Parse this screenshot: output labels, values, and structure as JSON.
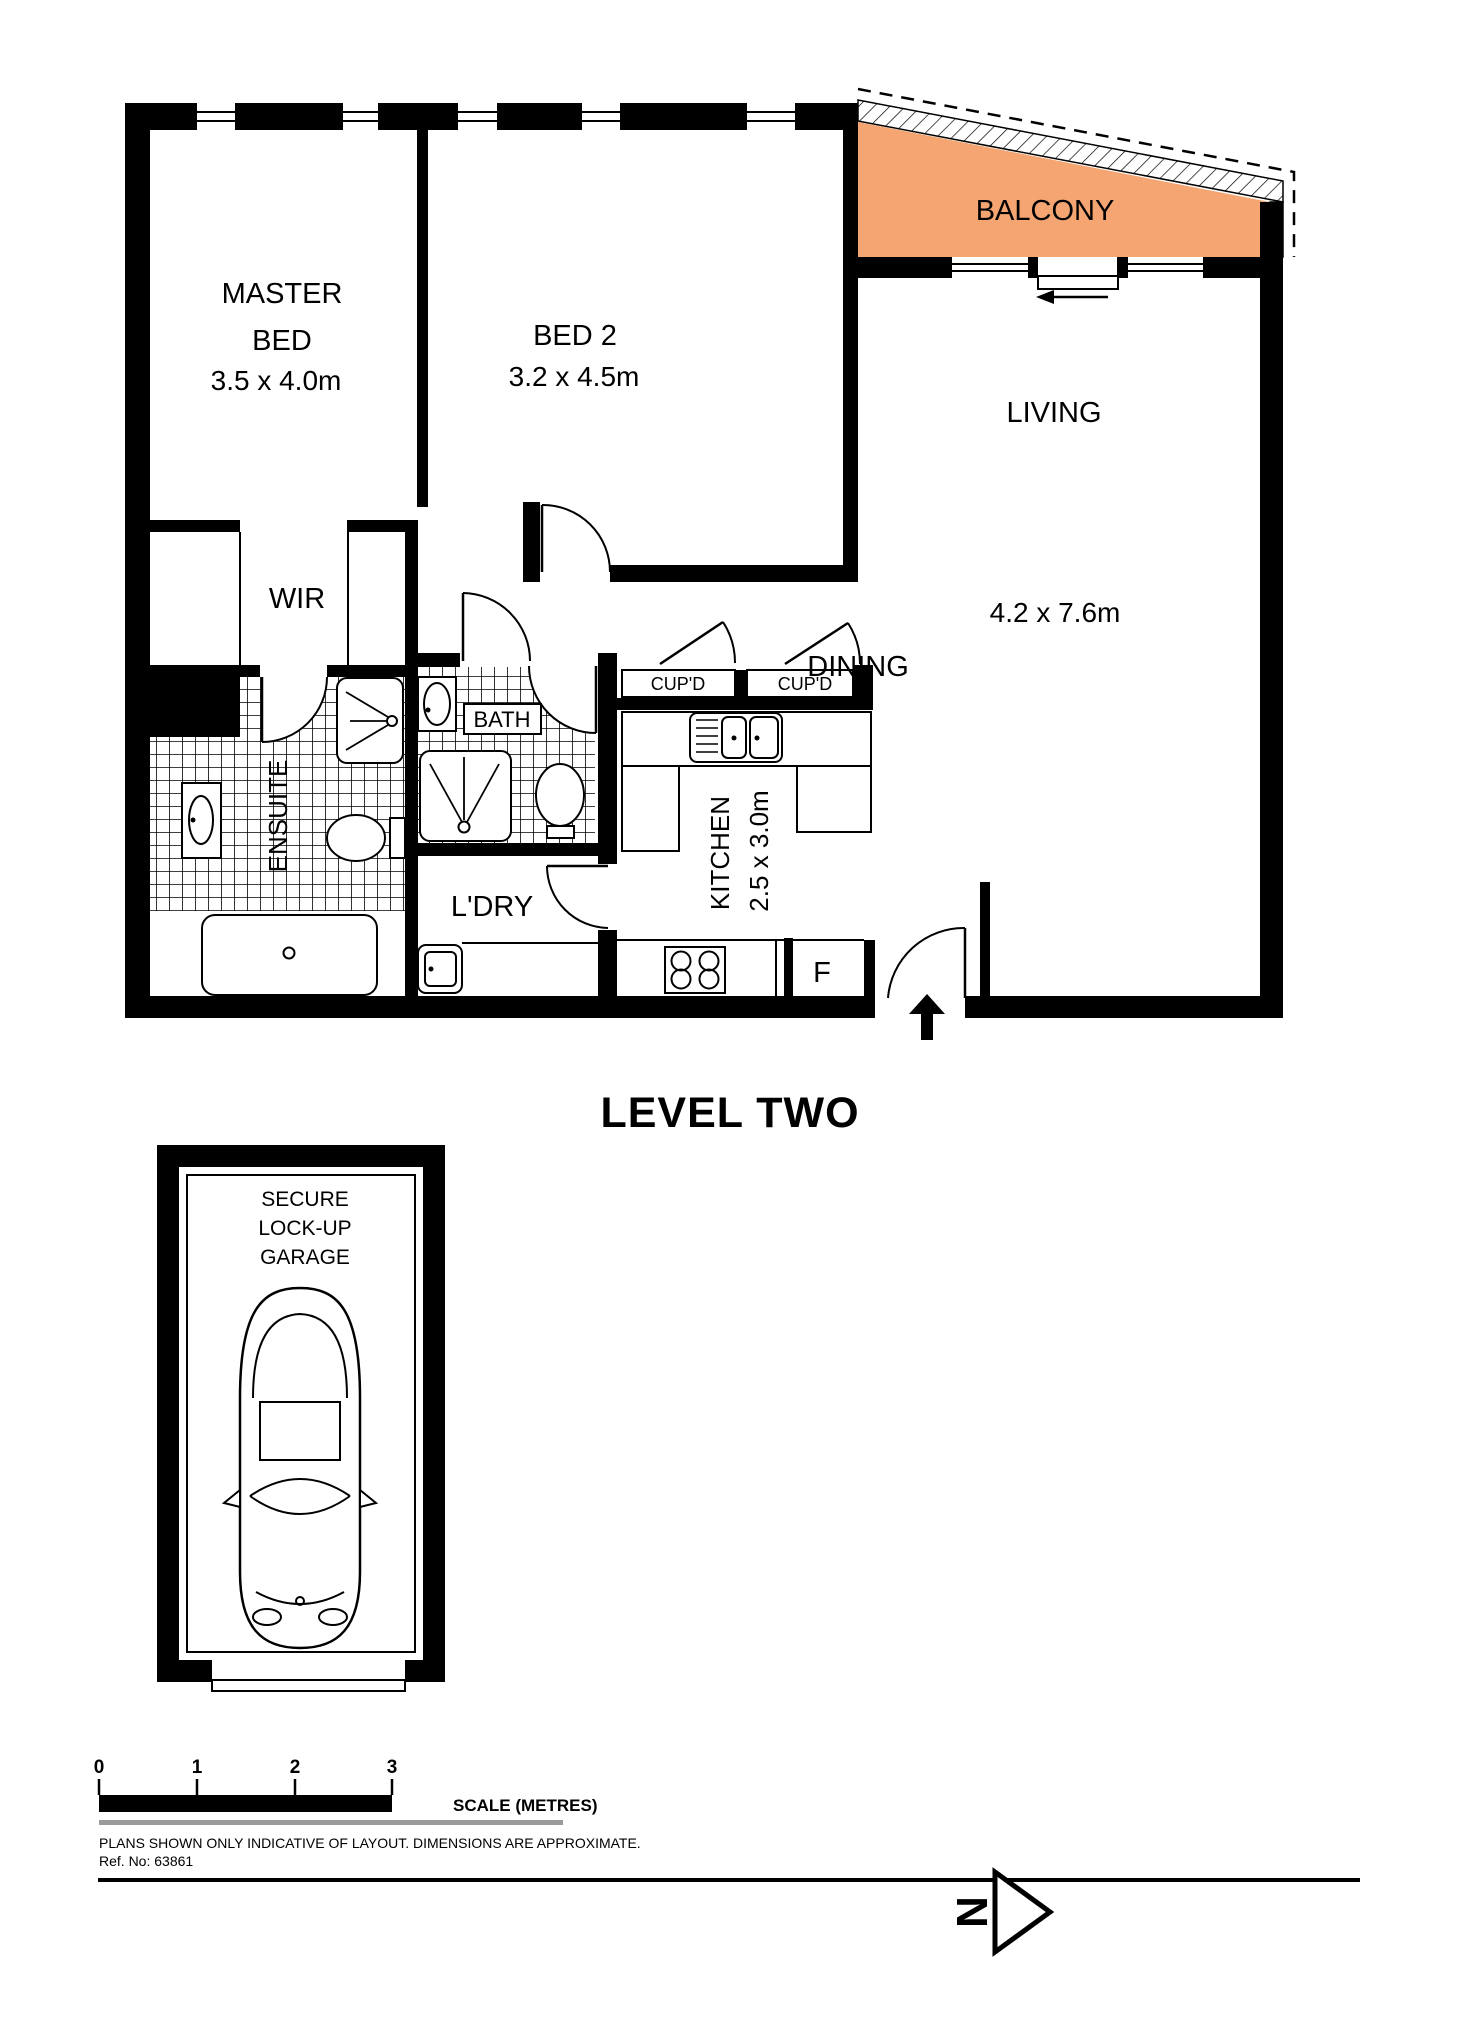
{
  "title": "LEVEL TWO",
  "colors": {
    "balcony_fill": "#F4A572",
    "wall": "#000000",
    "scale_gray": "#9B9B9B"
  },
  "rooms": {
    "master_bed": {
      "label_line1": "MASTER",
      "label_line2": "BED",
      "dims": "3.5 x 4.0m"
    },
    "bed2": {
      "label": "BED 2",
      "dims": "3.2 x 4.5m"
    },
    "living": {
      "label": "LIVING",
      "dims": "4.2 x 7.6m"
    },
    "dining": {
      "label": "DINING"
    },
    "balcony": {
      "label": "BALCONY"
    },
    "wir": {
      "label": "WIR"
    },
    "ensuite": {
      "label": "ENSUITE"
    },
    "bath": {
      "label": "BATH"
    },
    "laundry": {
      "label": "L'DRY"
    },
    "kitchen": {
      "label": "KITCHEN",
      "dims": "2.5 x 3.0m"
    },
    "cupboard_left": {
      "label": "CUP'D"
    },
    "cupboard_right": {
      "label": "CUP'D"
    },
    "fridge": {
      "label": "F"
    },
    "garage": {
      "label_line1": "SECURE",
      "label_line2": "LOCK-UP",
      "label_line3": "GARAGE"
    }
  },
  "scale_bar": {
    "ticks": [
      "0",
      "1",
      "2",
      "3"
    ],
    "label": "SCALE (METRES)"
  },
  "footer": {
    "disclaimer": "PLANS SHOWN ONLY INDICATIVE OF LAYOUT.  DIMENSIONS ARE APPROXIMATE.",
    "ref": "Ref. No: 63861"
  },
  "north": {
    "label": "N"
  }
}
